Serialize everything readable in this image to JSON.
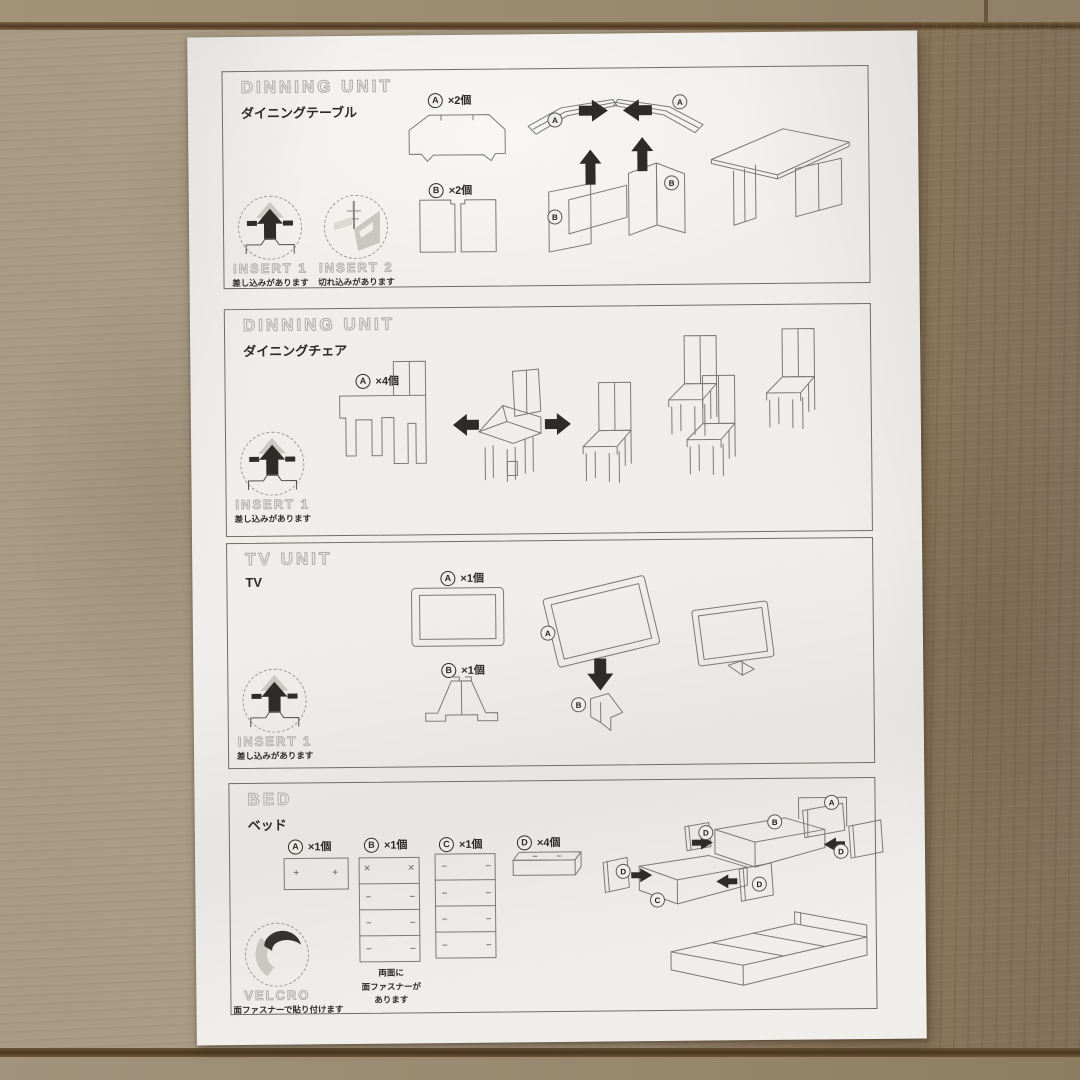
{
  "colors": {
    "floor_left": "#a79a84",
    "floor_right": "#82705a",
    "floor_joint": "#4e3a22",
    "paper": "#f0eeea",
    "print_line": "#7b7977",
    "print_black": "#2e2c29",
    "outline_text": "#b3b1ad"
  },
  "sections": [
    {
      "title": "DINNING UNIT",
      "subtitle": "ダイニングテーブル",
      "parts": [
        {
          "letter": "A",
          "qty": "×2個"
        },
        {
          "letter": "B",
          "qty": "×2個"
        }
      ],
      "badges": [
        {
          "label": "INSERT 1",
          "note": "差し込みがあります"
        },
        {
          "label": "INSERT 2",
          "note": "切れ込みがあります"
        }
      ],
      "diagram_labels": [
        "A",
        "A",
        "B",
        "B"
      ]
    },
    {
      "title": "DINNING UNIT",
      "subtitle": "ダイニングチェア",
      "parts": [
        {
          "letter": "A",
          "qty": "×4個"
        }
      ],
      "badges": [
        {
          "label": "INSERT 1",
          "note": "差し込みがあります"
        }
      ],
      "diagram_labels": []
    },
    {
      "title": "TV UNIT",
      "subtitle": "TV",
      "parts": [
        {
          "letter": "A",
          "qty": "×1個"
        },
        {
          "letter": "B",
          "qty": "×1個"
        }
      ],
      "badges": [
        {
          "label": "INSERT 1",
          "note": "差し込みがあります"
        }
      ],
      "diagram_labels": [
        "A",
        "B"
      ]
    },
    {
      "title": "BED",
      "subtitle": "ベッド",
      "parts": [
        {
          "letter": "A",
          "qty": "×1個"
        },
        {
          "letter": "B",
          "qty": "×1個"
        },
        {
          "letter": "C",
          "qty": "×1個"
        },
        {
          "letter": "D",
          "qty": "×4個"
        }
      ],
      "note_lines": [
        "両面に",
        "面ファスナーが",
        "あります"
      ],
      "badges": [
        {
          "label": "VELCRO",
          "note": "面ファスナーで貼り付けます"
        }
      ],
      "diagram_labels": [
        "A",
        "B",
        "D",
        "D",
        "D",
        "D",
        "C"
      ]
    }
  ]
}
